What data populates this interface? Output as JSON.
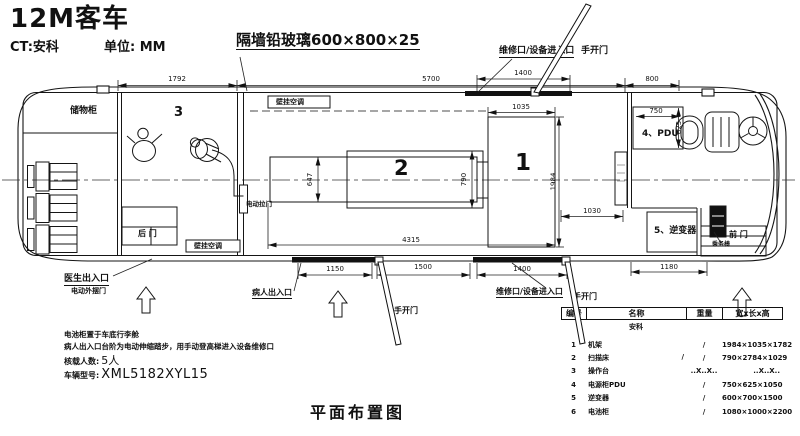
{
  "header": {
    "title": "12M客车",
    "ct": "CT:安科",
    "unit": "单位: MM",
    "glass_callout": "隔墙铅玻璃600×800×25"
  },
  "caption": "平面布置图",
  "labels": {
    "storage": "储物柜",
    "room3": "3",
    "room2": "2",
    "room1": "1",
    "rear_door": "后 门",
    "front_door": "前 门",
    "ac_top": "壁挂空调",
    "ac_bottom": "壁挂空调",
    "partition_door": "电动拉门",
    "pdu": "4、PDU",
    "inverter": "5、逆变器",
    "attendant_seat": "乘务椅",
    "doctor_exit": "医生出入口",
    "electric_swing_door": "电动外摆门",
    "patient_entrance": "病人出入口",
    "maint_top": "维修口/设备进入口",
    "maint_bottom": "维修口/设备进入口",
    "manual_door_top": "手开门",
    "manual_door_mid": "手开门",
    "manual_door_right": "手开门"
  },
  "dims": {
    "d1792": "1792",
    "d5700": "5700",
    "d1400_top": "1400",
    "d800": "800",
    "d1035": "1035",
    "d750": "750",
    "d625": "625",
    "d1984": "1984",
    "d647": "647",
    "d790": "790",
    "d1030": "1030",
    "d4315": "4315",
    "d1180": "1180",
    "d1150": "1150",
    "d1500": "1500",
    "d1400_bottom": "1400"
  },
  "notes": {
    "line1": "电池柜置于车底行李舱",
    "line2": "病人出入口台阶为电动伸缩踏步，用手动登高梯进入设备维修口",
    "capacity_label": "核载人数:",
    "capacity_value": "5人",
    "model_label": "车辆型号:",
    "model_value": "XML5182XYL15"
  },
  "table": {
    "headers": [
      "编号",
      "名称",
      "重量",
      "宽x长x高"
    ],
    "brand": "安科",
    "rows": [
      {
        "no": "1",
        "name": "机架",
        "mid": "",
        "weight": "/",
        "size": "1984×1035×1782"
      },
      {
        "no": "2",
        "name": "扫描床",
        "mid": "/",
        "weight": "/",
        "size": "790×2784×1029"
      },
      {
        "no": "3",
        "name": "操作台",
        "mid": "",
        "weight": "..X..X..",
        "size": "..X..X.."
      },
      {
        "no": "4",
        "name": "电源柜PDU",
        "mid": "",
        "weight": "/",
        "size": "750×625×1050"
      },
      {
        "no": "5",
        "name": "逆变器",
        "mid": "",
        "weight": "/",
        "size": "600×700×1500"
      },
      {
        "no": "6",
        "name": "电池柜",
        "mid": "",
        "weight": "/",
        "size": "1080×1000×2200"
      }
    ]
  }
}
